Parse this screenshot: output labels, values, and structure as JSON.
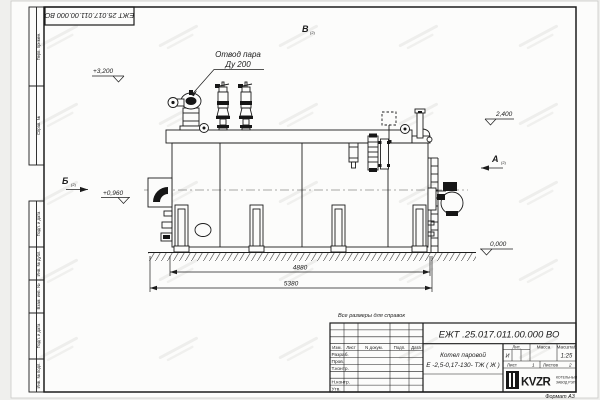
{
  "sheet": {
    "stamp_top_left": "ЕЖТ 25.017.011.00.000  ВО",
    "note": "Все размеры для справок",
    "format_label": "Формат  А3"
  },
  "margin_strips": [
    "Перв. примен.",
    "Справ. №",
    "Подп. и дата",
    "Инв. № дубл.",
    "Взам. инв. №",
    "Подп. и дата",
    "Инв. № подл."
  ],
  "annotations": {
    "steam_outlet_line1": "Отвод пара",
    "steam_outlet_line2": "Ду 200",
    "elev_top": "+3,200",
    "elev_drum": "2,400",
    "elev_burner": "+0,960",
    "elev_zero": "0,000",
    "view_a": "А",
    "view_b": "Б",
    "view_v": "В",
    "view_sheet_ref": "(2)"
  },
  "dimensions": {
    "inner_length": "4880",
    "overall_length": "5380"
  },
  "title_block": {
    "doc_number": "ЕЖТ .25.017.011.00.000  ВО",
    "product_name_line1": "Котел паровой",
    "product_name_line2": "Е -2,5-0,17-130- ТЖ ( Ж )",
    "header_cols": [
      "Изм.",
      "Лист",
      "N докум.",
      "Подп.",
      "Дата"
    ],
    "rows": [
      "Разраб.",
      "Пров.",
      "Т.контр.",
      "Н.контр.",
      "Утв."
    ],
    "lit_label": "Лит.",
    "lit_value": "И",
    "mass_label": "Масса",
    "scale_label": "Масштаб",
    "scale_value": "1:25",
    "sheet_label": "Лист",
    "sheet_value": "1",
    "sheets_label": "Листов",
    "sheets_value": "2",
    "logo_text": "KVZR",
    "logo_sub1": "КОТЕЛЬНЫЙ",
    "logo_sub2": "ЗАВОД РЭП"
  }
}
